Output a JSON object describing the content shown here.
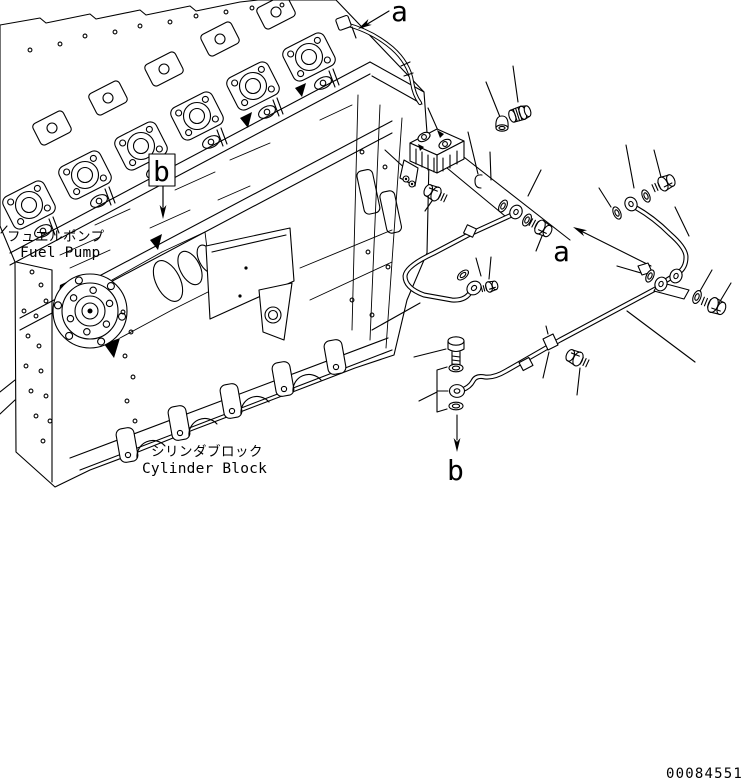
{
  "figure": {
    "type": "engine-parts-diagram",
    "callouts": {
      "a_top": "a",
      "b_engine": "b",
      "a_pipe": "a",
      "b_pipe": "b"
    },
    "labels": {
      "fuel_pump_jp": "フュエルポンプ",
      "fuel_pump_en": "Fuel Pump",
      "cylinder_block_jp": "シリンダブロック",
      "cylinder_block_en": "Cylinder Block"
    },
    "part_number": "00084551",
    "colors": {
      "ink": "#000000",
      "paper": "#ffffff"
    }
  }
}
